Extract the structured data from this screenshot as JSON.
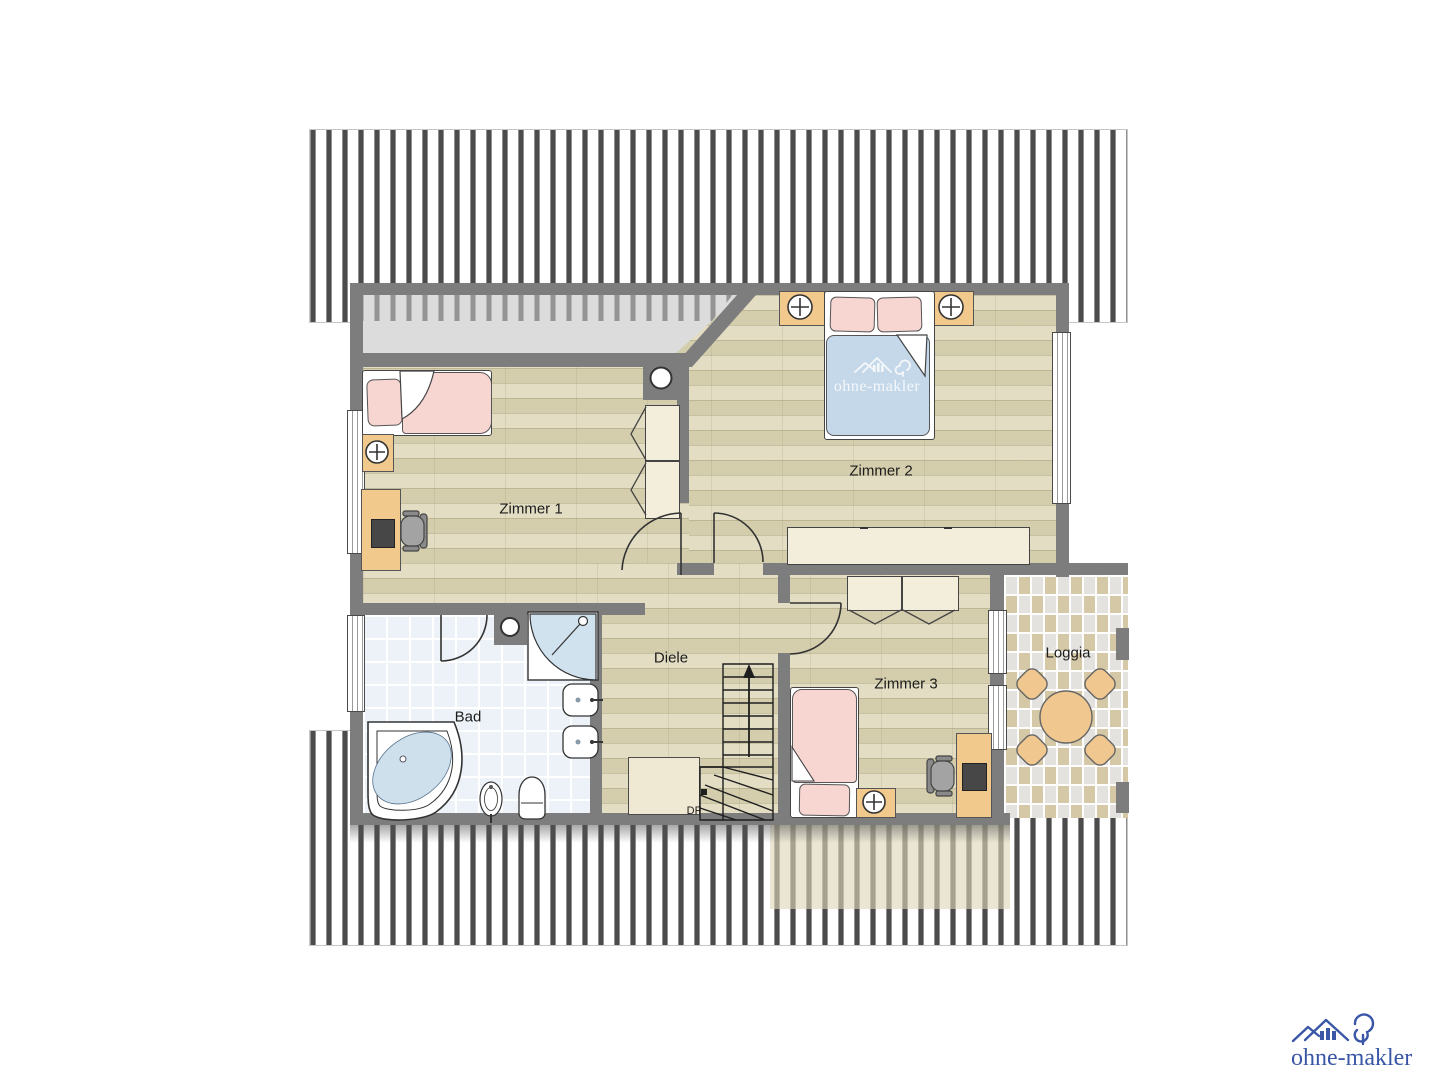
{
  "rooms": {
    "zimmer1": {
      "label": "Zimmer 1"
    },
    "zimmer2": {
      "label": "Zimmer 2"
    },
    "zimmer3": {
      "label": "Zimmer 3"
    },
    "bad": {
      "label": "Bad"
    },
    "diele": {
      "label": "Diele"
    },
    "loggia": {
      "label": "Loggia"
    }
  },
  "stairs": {
    "label": "DF"
  },
  "branding": {
    "watermark_text": "ohne-makler",
    "logo_text": "ohne-makler",
    "logo_color": "#3a57a7"
  },
  "colors": {
    "wall": "#7d7d7d",
    "wood_floor": "#ded8ba",
    "bath_tile": "#ecf2f7",
    "furniture_wood": "#f2c98c",
    "bed_pink": "#f7d6d2",
    "bed_blue": "#c5d8e9",
    "cabinet_cream": "#f3eddc",
    "roof_hatch": "#4c4c4c"
  }
}
